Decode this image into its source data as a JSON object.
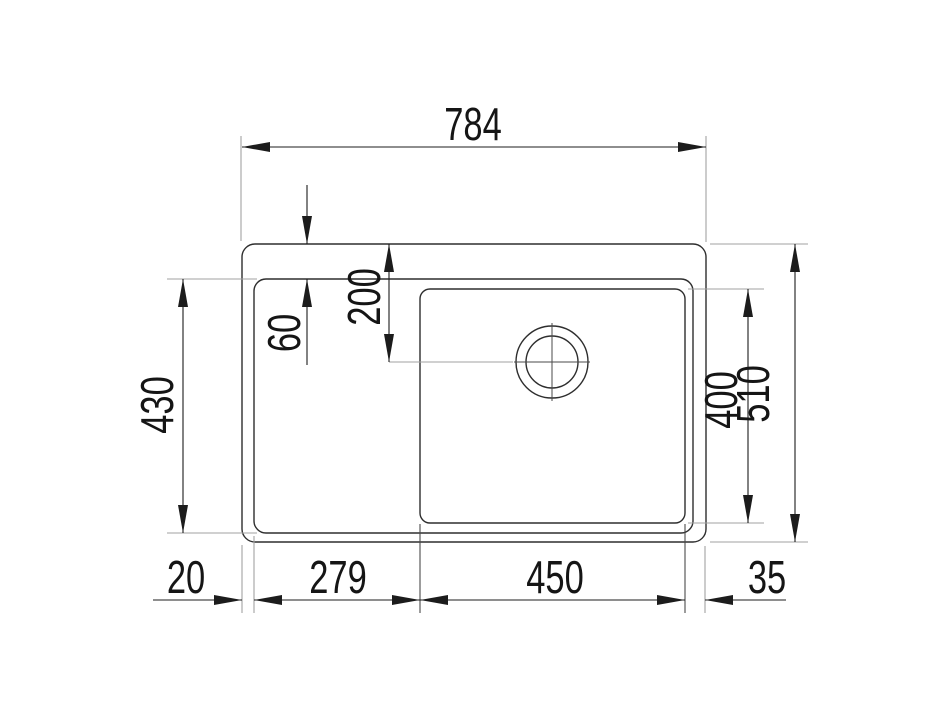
{
  "drawing": {
    "title": "Sink top view dimensioned technical drawing",
    "unit": "mm",
    "colors": {
      "background": "#ffffff",
      "outline": "#2e2e2e",
      "dimension_line": "#1c1c1c",
      "extension_line": "#a1a1a1"
    },
    "labels": {
      "overall_width": "784",
      "rim_inset_top": "60",
      "drain_center_from_top": "200",
      "inner_rim_depth": "430",
      "bowl_depth": "400",
      "overall_depth": "510",
      "left_edge_offset": "20",
      "ledge_width": "279",
      "bowl_width": "450",
      "right_edge_offset": "35"
    }
  }
}
